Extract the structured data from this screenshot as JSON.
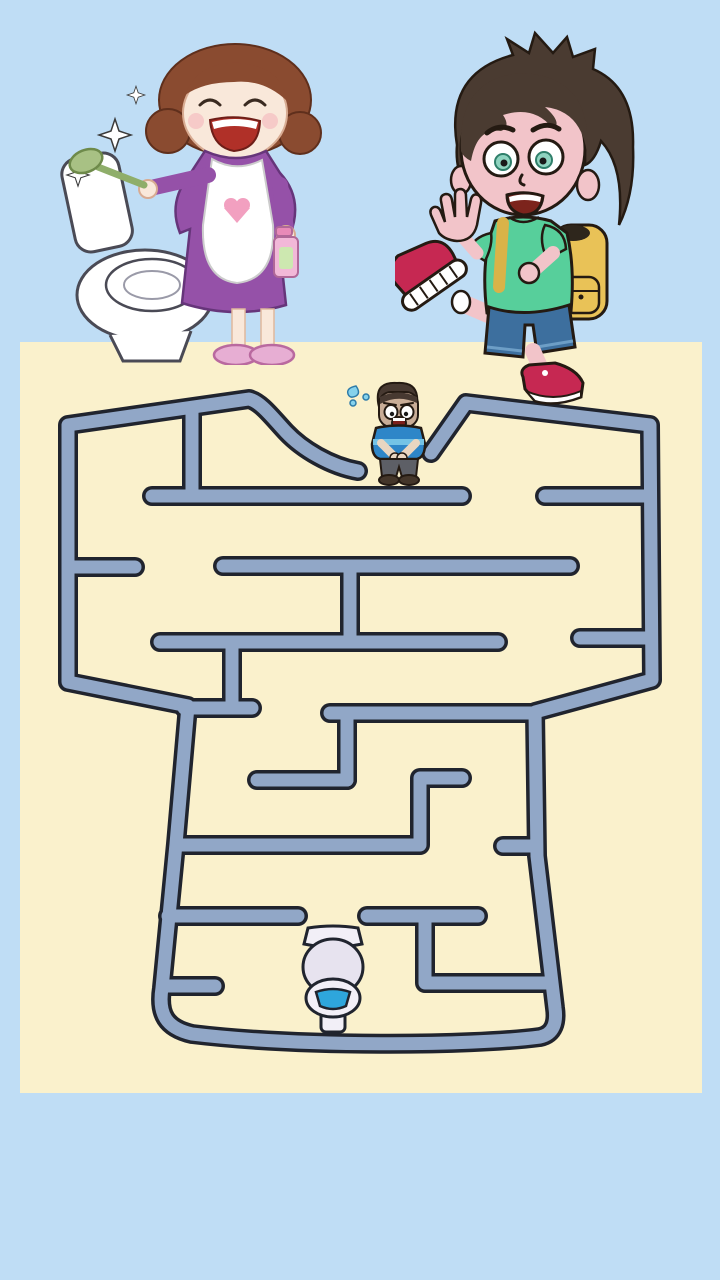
{
  "scene": {
    "background_color": "#BFDDF5",
    "board_color": "#FAF1CC",
    "wall_fill_color": "#91A7C7",
    "wall_outline_color": "#20242E",
    "board": {
      "x": 20,
      "y": 342,
      "width": 682,
      "height": 751
    }
  },
  "header": {
    "left_illustration": "mom-cleaning-toilet",
    "right_illustration": "boy-with-backpack-walking"
  },
  "maze": {
    "wall_thickness": 13,
    "outline_thickness": 20,
    "outer_path": "M 358 471 C 330 466 302 449 286 432 C 272 417 261 402 249 399 L 68 425 L 68 682 L 188 706 L 176 844 L 162 988 C 158 1014 166 1028 192 1034 C 300 1047 470 1046 540 1037 C 554 1034 557 1022 555 1008 L 537 856 L 535 712 L 652 680 L 650 425 L 466 403 L 431 453",
    "inner_walls": [
      "M 192 408 L 192 493",
      "M 152 496 L 462 496",
      "M 545 496 L 649 496",
      "M 68 567 L 135 567",
      "M 223 566 L 570 566",
      "M 350 566 L 350 642",
      "M 160 642 L 498 642",
      "M 232 642 L 232 705",
      "M 184 708 L 252 708",
      "M 580 638 L 649 638",
      "M 330 713 L 534 713",
      "M 347 713 L 347 780",
      "M 257 780 L 347 780",
      "M 462 778 L 420 778 L 420 845 L 177 845",
      "M 503 846 L 536 846",
      "M 168 916 L 298 916",
      "M 367 916 L 478 916",
      "M 425 916 L 425 983 L 550 983",
      "M 164 986 L 215 986"
    ]
  },
  "player": {
    "label": "desperate-man",
    "box_x": 340,
    "box_y": 380,
    "box_w": 90,
    "box_h": 110
  },
  "goal": {
    "label": "toilet",
    "box_x": 296,
    "box_y": 922,
    "box_w": 74,
    "box_h": 115
  }
}
